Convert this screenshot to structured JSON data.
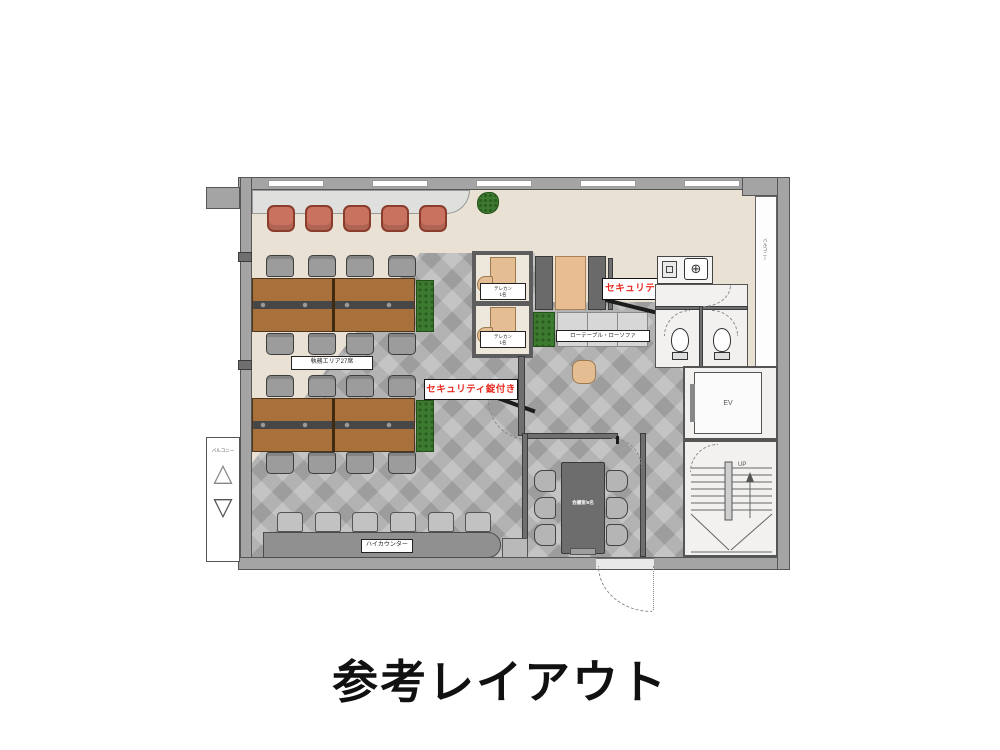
{
  "title": "参考レイアウト",
  "plan": {
    "work_area": {
      "label": "執務エリア27席"
    },
    "telecon_booth": {
      "line1": "テレカン",
      "line2": "1名"
    },
    "low_table": {
      "label": "ローテーブル・ローソファ"
    },
    "security": {
      "label": "セキュリティ錠付き",
      "color": "#e8281e"
    },
    "meeting_room": {
      "label": "会議室/6名"
    },
    "high_counter": {
      "label": "ハイカウンター"
    },
    "balcony": {
      "label": "バルコニー"
    },
    "elevator": {
      "label": "EV"
    },
    "stairs": {
      "label": "UP"
    },
    "icons": {
      "faucet": "⊕",
      "hatch_up": "△",
      "hatch_down": "▽",
      "up_arrow": "↑"
    }
  },
  "colors": {
    "floor_beige": "#e9e1d4",
    "tile_base": "#b3b3b3",
    "wall": "#a4a4a4",
    "desk_wood": "#a8713c",
    "chair_gray": "#9c9c9c",
    "lounge_chair": "#c97260",
    "plant_green": "#3c7a2f",
    "security_text": "#e8281e",
    "meeting_table": "#6d6d6d",
    "sofa_tan": "#e8bd92"
  }
}
